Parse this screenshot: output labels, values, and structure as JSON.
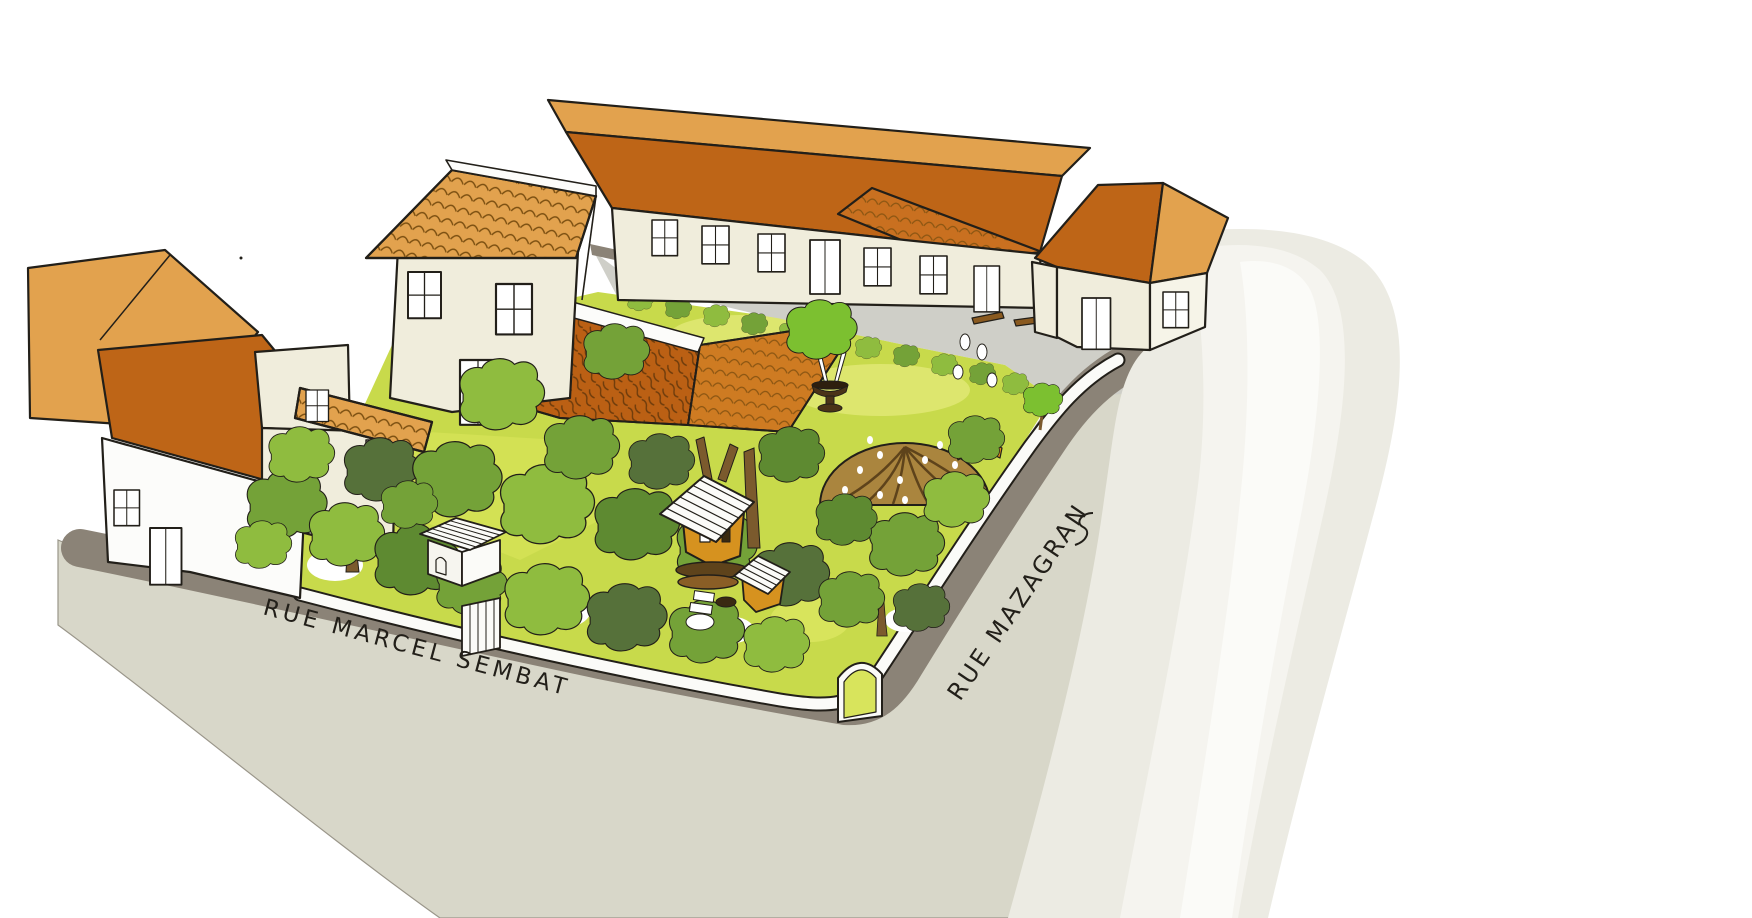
{
  "illustration": {
    "labels": {
      "marcel_sembat": "RUE MARCEL SEMBAT",
      "mazagran": "RUE MAZAGRAN"
    },
    "features": {
      "streets": [
        "rue-marcel-sembat",
        "rue-mazagran"
      ],
      "buildings": [
        "left-house-row",
        "bottom-left-house",
        "tall-house",
        "long-building-row",
        "corner-house",
        "garden-canopy-roof"
      ],
      "garden": [
        "community-garden",
        "tree-canopy",
        "willow-dome",
        "tree-house",
        "small-hut",
        "garden-shed",
        "garden-gate",
        "corner-arch-entrance",
        "fountain",
        "benches",
        "hedge-row"
      ]
    },
    "palette": {
      "paper": "#FFFFFF",
      "street_light": "#D8D7C9",
      "street_shadow": "#8B8377",
      "street_upper": "#CFCFC8",
      "watercolor_wash": "#ECEBE3",
      "wash_streak": "#F5F4EF",
      "wall_cream": "#F0EDDC",
      "wall_white": "#FCFCFA",
      "roof_tan": "#E2A24E",
      "roof_orange": "#BE6517",
      "garden_roof": "#BB6014",
      "lawn": "#C8DA4B",
      "lawn_light": "#DDE66E",
      "tree_green_light": "#8FBC3F",
      "tree_green_mid": "#74A238",
      "tree_green_dark": "#5E8A31",
      "tree_green_olive": "#56713A",
      "tree_green_bright": "#7CC030",
      "willow_dome": "#AA853E",
      "dome_rib": "#5E431B",
      "treehouse_orange": "#D6921F",
      "trunk_brown": "#7B5A2D",
      "ink": "#221F19"
    }
  }
}
